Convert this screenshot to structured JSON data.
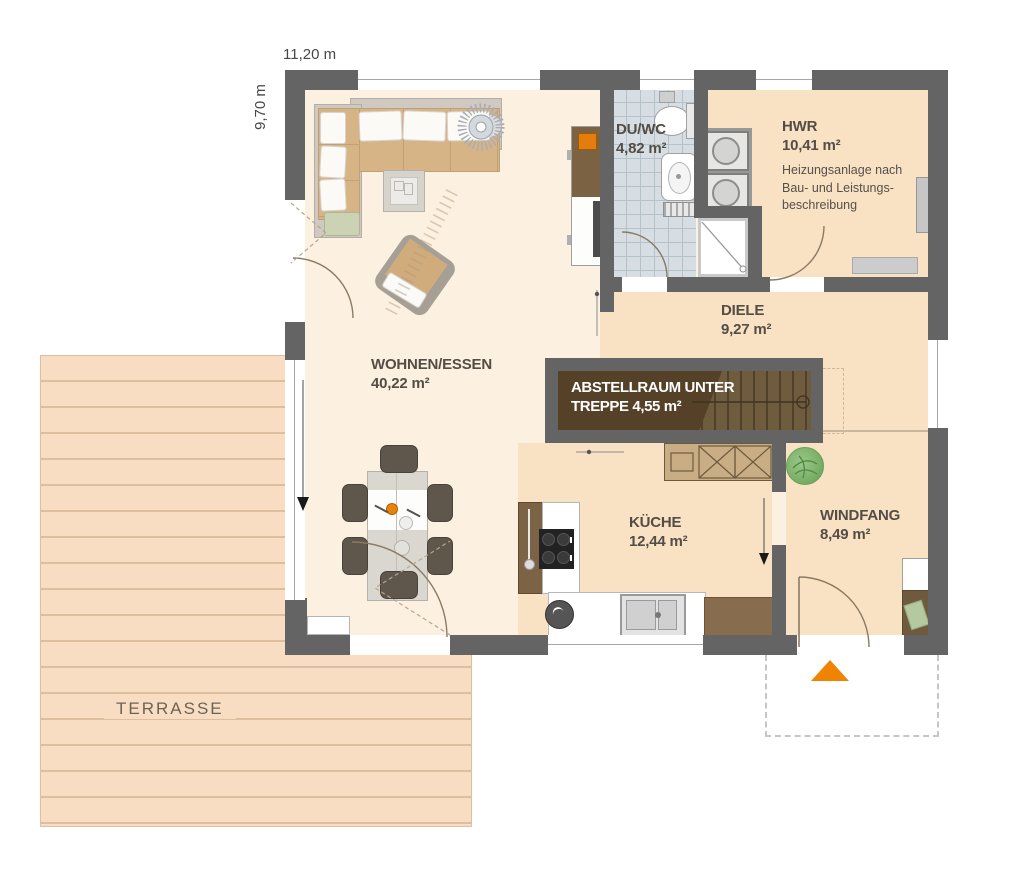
{
  "plan": {
    "width_label": "11,20 m",
    "height_label": "9,70 m",
    "terrace_label": "TERRASSE"
  },
  "rooms": {
    "wohnen": {
      "name": "WOHNEN/ESSEN",
      "area": "40,22 m²"
    },
    "duwc": {
      "name": "DU/WC",
      "area": "4,82 m²"
    },
    "hwr": {
      "name": "HWR",
      "area": "10,41 m²",
      "notes": [
        "Heizungsanlage nach",
        "Bau- und Leistungs-",
        "beschreibung"
      ]
    },
    "diele": {
      "name": "DIELE",
      "area": "9,27 m²"
    },
    "abstellraum": {
      "line1": "ABSTELLRAUM UNTER",
      "line2": "TREPPE 4,55 m²"
    },
    "kueche": {
      "name": "KÜCHE",
      "area": "12,44 m²"
    },
    "windfang": {
      "name": "WINDFANG",
      "area": "8,49 m²"
    }
  },
  "colors": {
    "wall_gray": "#646464",
    "floor_light": "#fcf1e0",
    "floor_warm": "#f9e1c4",
    "tile_blue": "#d6dee3",
    "terrace": "#f8ddc2",
    "stair_wood": "#6f5c3e",
    "accent_orange": "#f08300",
    "plant_green": "#85bb74"
  }
}
